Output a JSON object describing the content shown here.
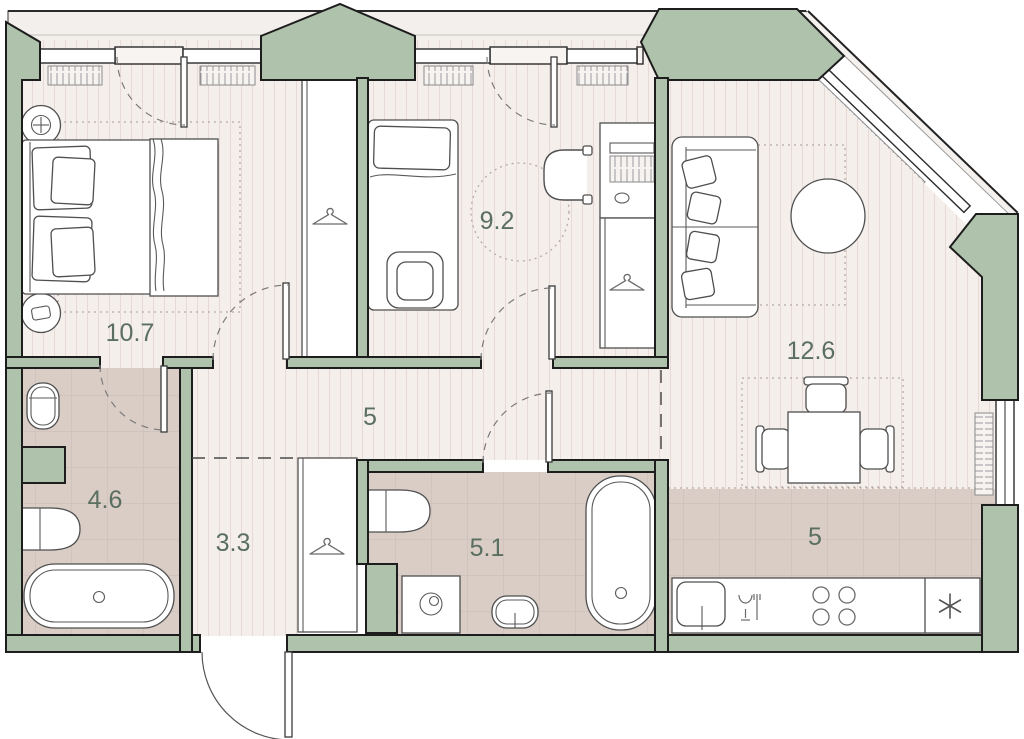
{
  "plan": {
    "type": "apartment-floor-plan",
    "rooms": [
      {
        "id": "bedroom",
        "area_label": "10.7"
      },
      {
        "id": "bedroom-2",
        "area_label": "9.2"
      },
      {
        "id": "living-room",
        "area_label": "12.6"
      },
      {
        "id": "hallway",
        "area_label": "5"
      },
      {
        "id": "bathroom",
        "area_label": "4.6"
      },
      {
        "id": "corridor",
        "area_label": "3.3"
      },
      {
        "id": "bathroom-2",
        "area_label": "5.1"
      },
      {
        "id": "kitchen",
        "area_label": "5"
      }
    ],
    "colors": {
      "wall_fill": "#afc2ab",
      "outline": "#1d1d1d",
      "wood_floor": "#f5efec",
      "wood_stripe": "#e7dad6",
      "tile_floor": "#d9cdc6",
      "tile_line": "#c9bcb5",
      "label_text": "#5a6f60",
      "balcony_fill": "#f2efec"
    },
    "fixtures": [
      "double-bed",
      "nightstand-lamp",
      "nightstand-phone",
      "wardrobe-hanger",
      "single-bed",
      "desk-computer",
      "office-chair",
      "sofa-with-pillows",
      "round-rug",
      "dining-table-with-chairs",
      "freestanding-bathtub",
      "bathtub",
      "toilet",
      "washbasin",
      "washing-machine",
      "kitchen-sink",
      "cooktop-burners",
      "fridge-asterisk",
      "glass-and-fork",
      "radiator",
      "window",
      "door-swing",
      "duct-shaft"
    ]
  }
}
